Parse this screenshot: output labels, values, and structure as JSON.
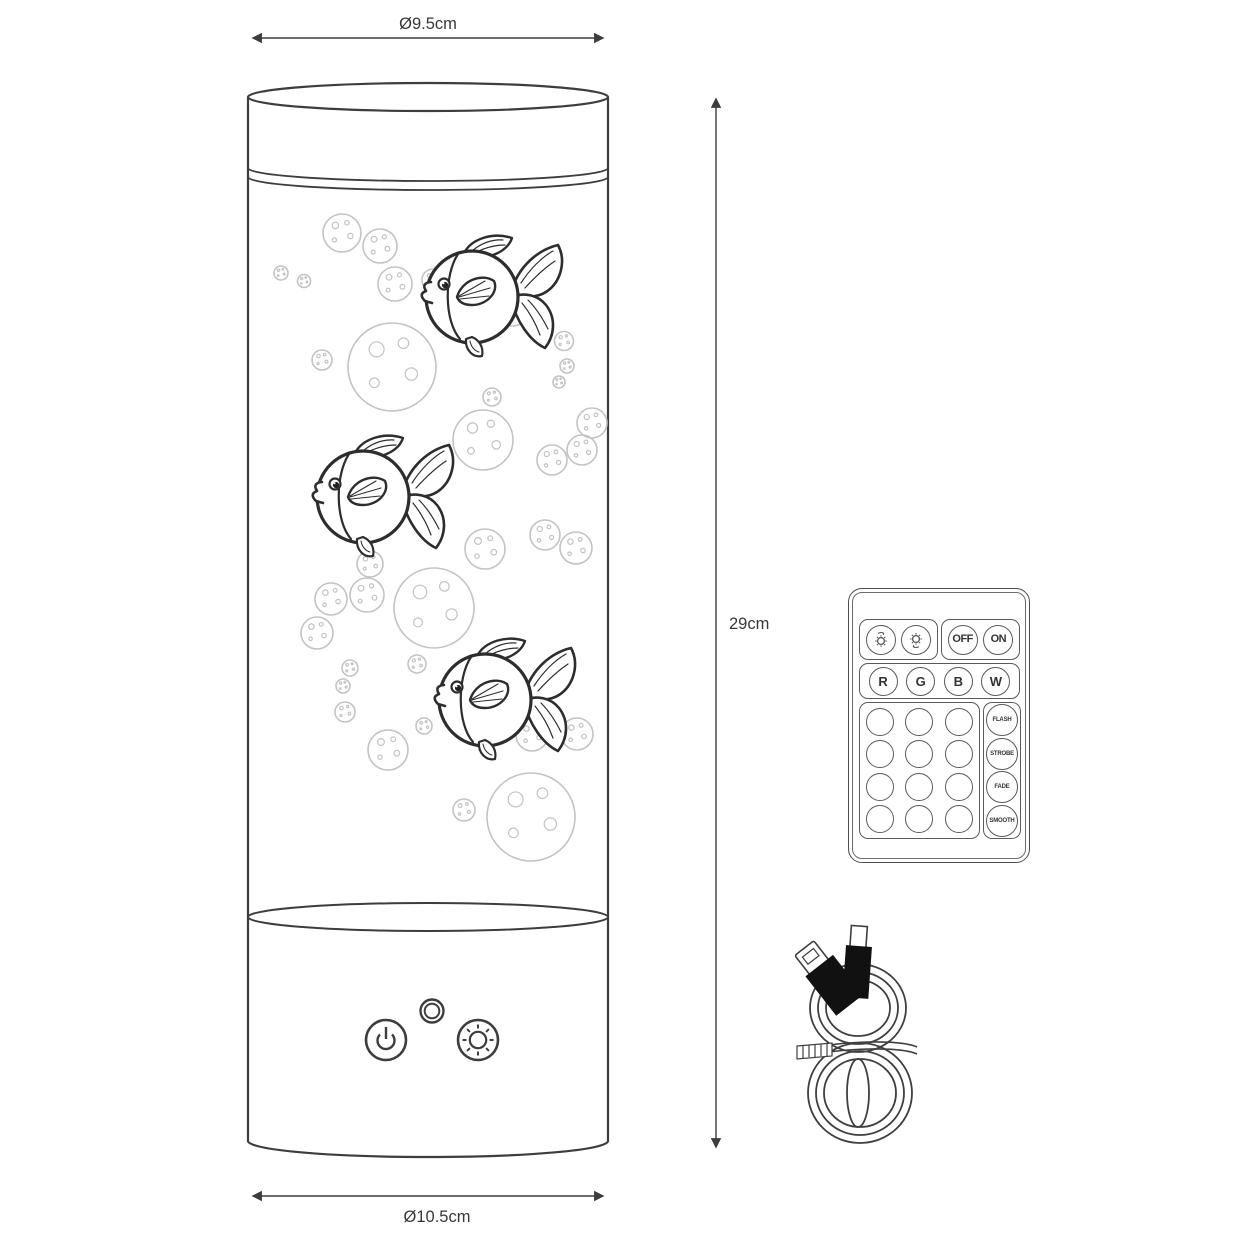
{
  "diagram": {
    "kind": "product-dimension-diagram",
    "background": "#ffffff"
  },
  "dimensions": {
    "top_diameter": "Ø9.5cm",
    "height": "29cm",
    "bottom_diameter": "Ø10.5cm"
  },
  "remote": {
    "off": "OFF",
    "on": "ON",
    "color_buttons": [
      "R",
      "G",
      "B",
      "W"
    ],
    "effect_buttons": [
      "FLASH",
      "STROBE",
      "FADE",
      "SMOOTH"
    ],
    "blank_button_count": 12,
    "icons": {
      "brightness_up": "sun-up-icon",
      "brightness_down": "sun-down-icon"
    }
  },
  "lamp": {
    "fish_count": 3,
    "icons": {
      "power": "power-icon",
      "indicator": "led-ring-icon",
      "brightness": "sun-icon"
    }
  },
  "colors": {
    "line": "#3d3d3d",
    "fish_line": "#2d2d2d",
    "bubble_line": "#c3c3c3",
    "remote_line": "#5a5a5a",
    "text": "#383838"
  }
}
